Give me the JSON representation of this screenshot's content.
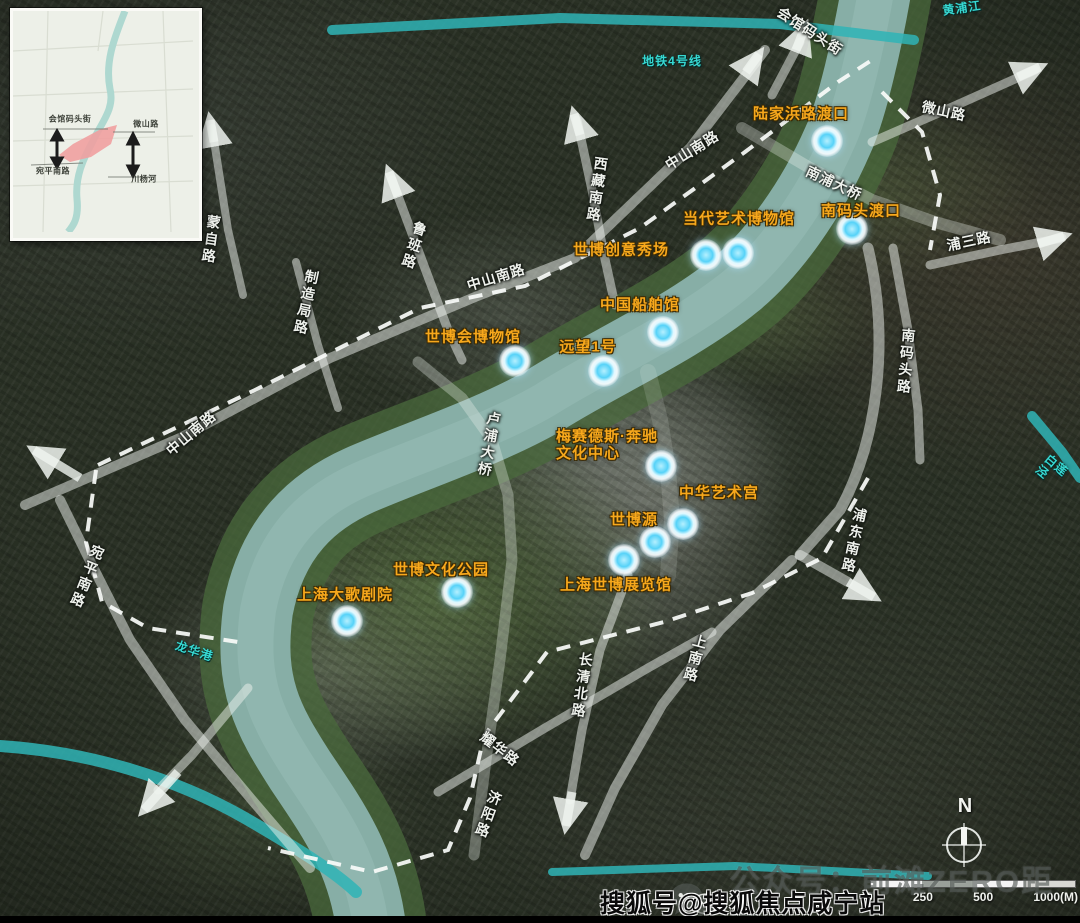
{
  "compass": {
    "north_label": "N"
  },
  "scalebar": {
    "ticks": [
      "0",
      "250",
      "500",
      "1000(M)"
    ]
  },
  "watermark": {
    "wechat_line": "公众号：前滩ZERO距离",
    "sohu_line": "搜狐号@搜狐焦点咸宁站"
  },
  "colors": {
    "landmark_text": "#f7a81c",
    "marker_center": "#56d2f8",
    "waterway_overlay": "#2fb4b6",
    "road_overlay": "rgba(238,242,238,0.55)",
    "river": "#87aea6"
  },
  "inset": {
    "labels": [
      {
        "text": "会馆码头街",
        "x": 57,
        "y": 108
      },
      {
        "text": "微山路",
        "x": 133,
        "y": 113
      },
      {
        "text": "宛平南路",
        "x": 40,
        "y": 160
      },
      {
        "text": "川杨河",
        "x": 131,
        "y": 168
      }
    ]
  },
  "map": {
    "road_labels": [
      {
        "text": "会馆码头街",
        "x": 810,
        "y": 31,
        "rot": 33
      },
      {
        "text": "微山路",
        "x": 944,
        "y": 111,
        "rot": 12
      },
      {
        "text": "中山南路",
        "x": 692,
        "y": 150,
        "rot": -32
      },
      {
        "text": "西藏南路",
        "x": 597,
        "y": 190,
        "rot": 8,
        "vertical": true
      },
      {
        "text": "鲁班路",
        "x": 414,
        "y": 246,
        "rot": 18,
        "vertical": true
      },
      {
        "text": "中山南路",
        "x": 496,
        "y": 277,
        "rot": -17
      },
      {
        "text": "制造局路",
        "x": 306,
        "y": 303,
        "rot": 12,
        "vertical": true
      },
      {
        "text": "蒙自路",
        "x": 211,
        "y": 240,
        "rot": 8,
        "vertical": true
      },
      {
        "text": "南浦大桥",
        "x": 834,
        "y": 183,
        "rot": 25
      },
      {
        "text": "卢浦大桥",
        "x": 489,
        "y": 445,
        "rot": 10,
        "vertical": true
      },
      {
        "text": "中山南路",
        "x": 191,
        "y": 433,
        "rot": -40
      },
      {
        "text": "宛平南路",
        "x": 87,
        "y": 577,
        "rot": 22,
        "vertical": true
      },
      {
        "text": "耀华路",
        "x": 500,
        "y": 749,
        "rot": 38
      },
      {
        "text": "济阳路",
        "x": 488,
        "y": 815,
        "rot": 20,
        "vertical": true
      },
      {
        "text": "长清北路",
        "x": 582,
        "y": 686,
        "rot": 8,
        "vertical": true
      },
      {
        "text": "上南路",
        "x": 695,
        "y": 659,
        "rot": 15,
        "vertical": true
      },
      {
        "text": "浦东南路",
        "x": 854,
        "y": 541,
        "rot": 12,
        "vertical": true
      },
      {
        "text": "南码头路",
        "x": 906,
        "y": 362,
        "rot": 5,
        "vertical": true
      },
      {
        "text": "浦三路",
        "x": 969,
        "y": 241,
        "rot": -12
      }
    ],
    "waterway_labels": [
      {
        "text": "地铁4号线",
        "x": 672,
        "y": 62,
        "rot": 0
      },
      {
        "text": "黄浦江",
        "x": 962,
        "y": 9,
        "rot": -8
      },
      {
        "text": "龙华港",
        "x": 194,
        "y": 652,
        "rot": 18
      },
      {
        "text": "白莲泾",
        "x": 1052,
        "y": 472,
        "rot": 40
      }
    ],
    "landmarks": [
      {
        "name": "陆家浜路渡口",
        "label_x": 801,
        "label_y": 114,
        "marker_x": 827,
        "marker_y": 141
      },
      {
        "name": "南码头渡口",
        "label_x": 861,
        "label_y": 211,
        "marker_x": 852,
        "marker_y": 229
      },
      {
        "name": "当代艺术博物馆",
        "label_x": 739,
        "label_y": 219,
        "marker_x": 738,
        "marker_y": 253
      },
      {
        "name": "世博创意秀场",
        "label_x": 621,
        "label_y": 250,
        "marker_x": 706,
        "marker_y": 255
      },
      {
        "name": "中国船舶馆",
        "label_x": 640,
        "label_y": 305,
        "marker_x": 663,
        "marker_y": 332
      },
      {
        "name": "世博会博物馆",
        "label_x": 473,
        "label_y": 337,
        "marker_x": 515,
        "marker_y": 361
      },
      {
        "name": "远望1号",
        "label_x": 588,
        "label_y": 347,
        "marker_x": 604,
        "marker_y": 371
      },
      {
        "name": "梅赛德斯·奔驰\n文化中心",
        "label_x": 556,
        "label_y": 428,
        "marker_x": 661,
        "marker_y": 466,
        "anchor": "tl"
      },
      {
        "name": "中华艺术宫",
        "label_x": 719,
        "label_y": 493,
        "marker_x": 683,
        "marker_y": 524
      },
      {
        "name": "世博源",
        "label_x": 634,
        "label_y": 520,
        "marker_x": 655,
        "marker_y": 542
      },
      {
        "name": "上海世博展览馆",
        "label_x": 616,
        "label_y": 585,
        "marker_x": 624,
        "marker_y": 560
      },
      {
        "name": "世博文化公园",
        "label_x": 441,
        "label_y": 570,
        "marker_x": 457,
        "marker_y": 592
      },
      {
        "name": "上海大歌剧院",
        "label_x": 345,
        "label_y": 595,
        "marker_x": 347,
        "marker_y": 621
      }
    ]
  }
}
